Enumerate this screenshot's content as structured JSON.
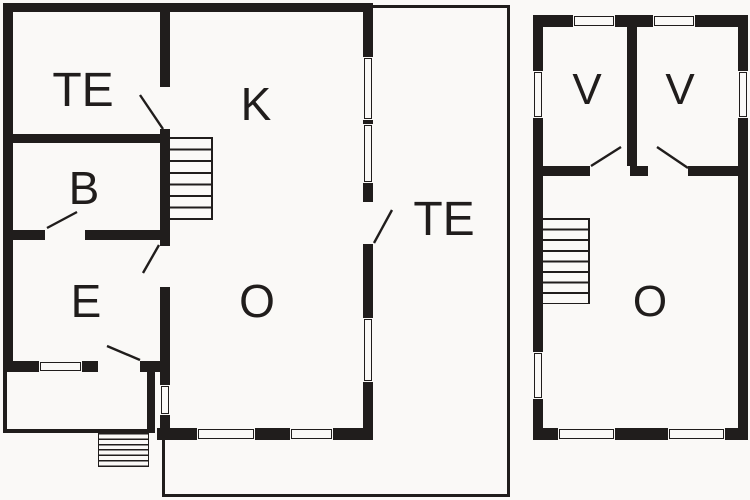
{
  "colors": {
    "wall": "#201d1c",
    "background": "#faf9f7",
    "label": "#201d1c"
  },
  "ground_floor": {
    "labels": {
      "terrace_room": "TE",
      "kitchen": "K",
      "bathroom": "B",
      "entry": "E",
      "living_room": "O",
      "terrace": "TE"
    }
  },
  "upper_floor": {
    "labels": {
      "bedroom_left": "V",
      "bedroom_right": "V",
      "landing": "O"
    }
  }
}
